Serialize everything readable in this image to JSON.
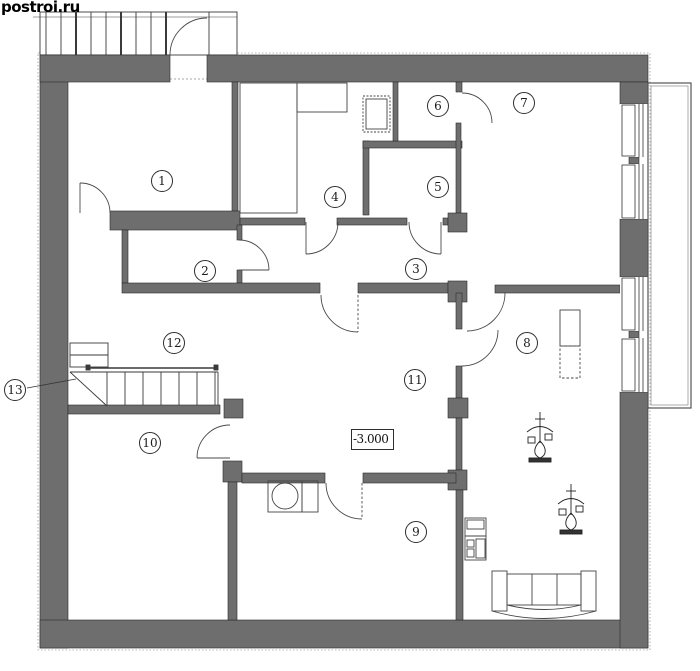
{
  "watermark": {
    "text": "postroi.ru"
  },
  "plan": {
    "elevation_label": "-3.000",
    "room_labels": [
      {
        "number": "1",
        "x": 162,
        "y": 181
      },
      {
        "number": "2",
        "x": 205,
        "y": 271
      },
      {
        "number": "3",
        "x": 416,
        "y": 269
      },
      {
        "number": "4",
        "x": 335,
        "y": 197
      },
      {
        "number": "5",
        "x": 438,
        "y": 187
      },
      {
        "number": "6",
        "x": 438,
        "y": 106
      },
      {
        "number": "7",
        "x": 524,
        "y": 103
      },
      {
        "number": "8",
        "x": 527,
        "y": 343
      },
      {
        "number": "9",
        "x": 416,
        "y": 532
      },
      {
        "number": "10",
        "x": 150,
        "y": 443
      },
      {
        "number": "11",
        "x": 415,
        "y": 380
      },
      {
        "number": "12",
        "x": 174,
        "y": 343
      },
      {
        "number": "13",
        "x": 15,
        "y": 390
      }
    ],
    "colors": {
      "wall": "#6e6e6e",
      "line": "#2e2e2e",
      "background": "#ffffff"
    }
  }
}
